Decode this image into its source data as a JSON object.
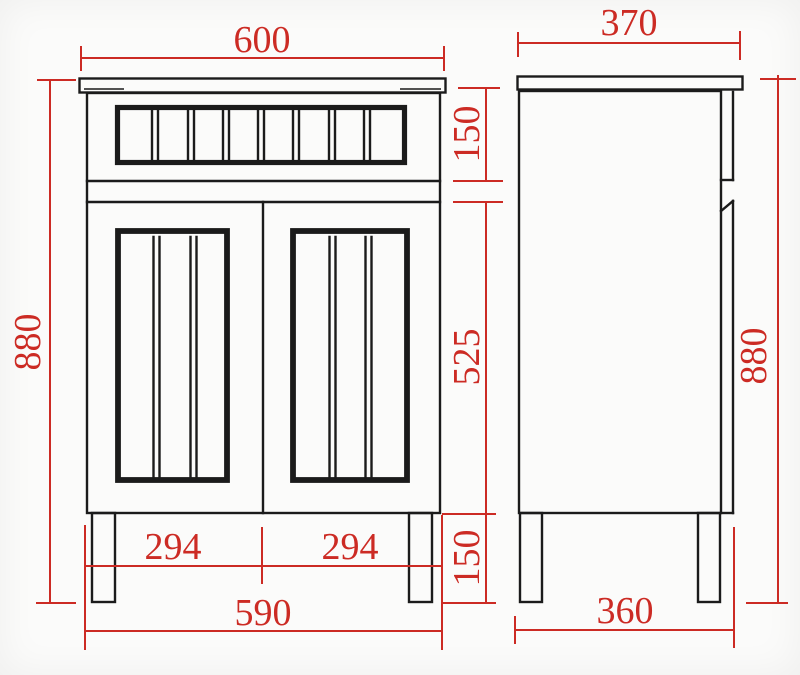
{
  "colors": {
    "dimension_red": "#cc2b24",
    "outline_black": "#1b1b1b",
    "background": "#fbfbfa"
  },
  "front_view": {
    "dims": {
      "top_width": "600",
      "overall_height": "880",
      "drawer_height": "150",
      "door_height": "525",
      "leg_height": "150",
      "left_door_width": "294",
      "right_door_width": "294",
      "bottom_width": "590"
    }
  },
  "side_view": {
    "dims": {
      "top_depth": "370",
      "overall_height": "880",
      "bottom_depth": "360"
    }
  }
}
